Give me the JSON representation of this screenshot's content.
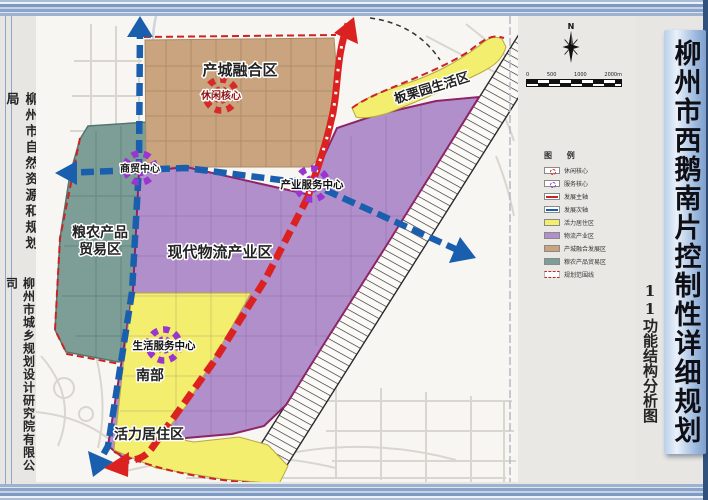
{
  "left_panel": {
    "agency_1": "柳州市自然资源和规划局",
    "agency_2": "柳州市城乡规划设计研究院有限公司"
  },
  "right_panel": {
    "figure_no_label": "11功能结构分析图",
    "title": "柳州市西鹅南片控制性详细规划"
  },
  "map": {
    "zones": {
      "industry_city": {
        "label": "产城融合区",
        "color": "#c9a47f"
      },
      "chestnut": {
        "label": "板栗园生活区",
        "color": "#f3ee6d"
      },
      "grain_line1": "粮农产品",
      "grain_line2": "贸易区",
      "grain_color": "#7d9e97",
      "logistics": {
        "label": "现代物流产业区",
        "color": "#b18fcb"
      },
      "south_line1": "南部",
      "south_line2": "活力居住区",
      "south_color": "#f3ee6d"
    },
    "cores": {
      "leisure": {
        "label": "休闲核心",
        "color": "#d62a2a"
      },
      "trade": {
        "label": "商贸中心",
        "color": "#9a35cf"
      },
      "industry_service": {
        "label": "产业服务中心",
        "color": "#9a35cf"
      },
      "life_service": {
        "label": "生活服务中心",
        "color": "#9a35cf"
      }
    },
    "axes": {
      "main_axis_color": "#dc2121",
      "secondary_axis_color": "#1a5fae"
    },
    "compass_n": "N",
    "scale_labels": [
      "0",
      "500",
      "1000",
      "2000m"
    ],
    "legend": {
      "title": "图 例",
      "items": [
        {
          "label": "休闲核心",
          "swatch": "core-red"
        },
        {
          "label": "服务核心",
          "swatch": "core-purple"
        },
        {
          "label": "发展主轴",
          "swatch": "axis-red"
        },
        {
          "label": "发展次轴",
          "swatch": "axis-blue"
        },
        {
          "label": "活力居住区",
          "swatch": "fill-yellow",
          "color": "#f3ee6d"
        },
        {
          "label": "物流产业区",
          "swatch": "fill-purple",
          "color": "#b18fcb"
        },
        {
          "label": "产城融合发展区",
          "swatch": "fill-tan",
          "color": "#c9a47f"
        },
        {
          "label": "粮农产品贸易区",
          "swatch": "fill-teal",
          "color": "#7d9e97"
        },
        {
          "label": "规划范围线",
          "swatch": "boundary"
        }
      ]
    }
  }
}
